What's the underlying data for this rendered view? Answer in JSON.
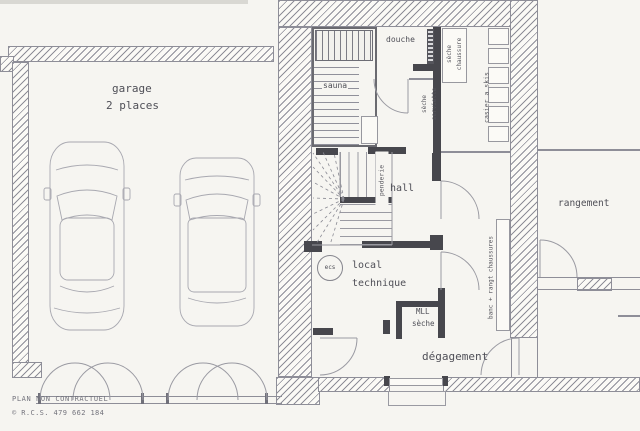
{
  "meta": {
    "footer_line1": "PLAN NON CONTRACTUEL",
    "footer_line2": "© R.C.S. 479 662 184"
  },
  "rooms": {
    "garage": {
      "label": "garage",
      "sublabel": "2 places"
    },
    "sauna": {
      "label": "sauna"
    },
    "douche": {
      "label": "douche"
    },
    "hall": {
      "label": "hall"
    },
    "local_technique": {
      "line1": "local",
      "line2": "technique"
    },
    "degagement": {
      "label": "dégagement"
    },
    "rangement": {
      "label": "rangement"
    }
  },
  "fixtures": {
    "seche_serviette": {
      "line1": "sèche",
      "line2": "serviette"
    },
    "seche_chaussure": {
      "line1": "sèche",
      "line2": "chaussure"
    },
    "casier_skis": {
      "label": "casier a skis"
    },
    "penderie": {
      "label": "penderie"
    },
    "banc": {
      "label": "banc + rangt chaussures"
    },
    "ecs": {
      "label": "ecs"
    },
    "mll": {
      "label": "MLL"
    },
    "seche_linge": {
      "label": "sèche"
    }
  },
  "colors": {
    "paper": "#f6f5f1",
    "line": "#8e8e98",
    "dark_wall": "#47474d",
    "text": "#4f4f57"
  }
}
